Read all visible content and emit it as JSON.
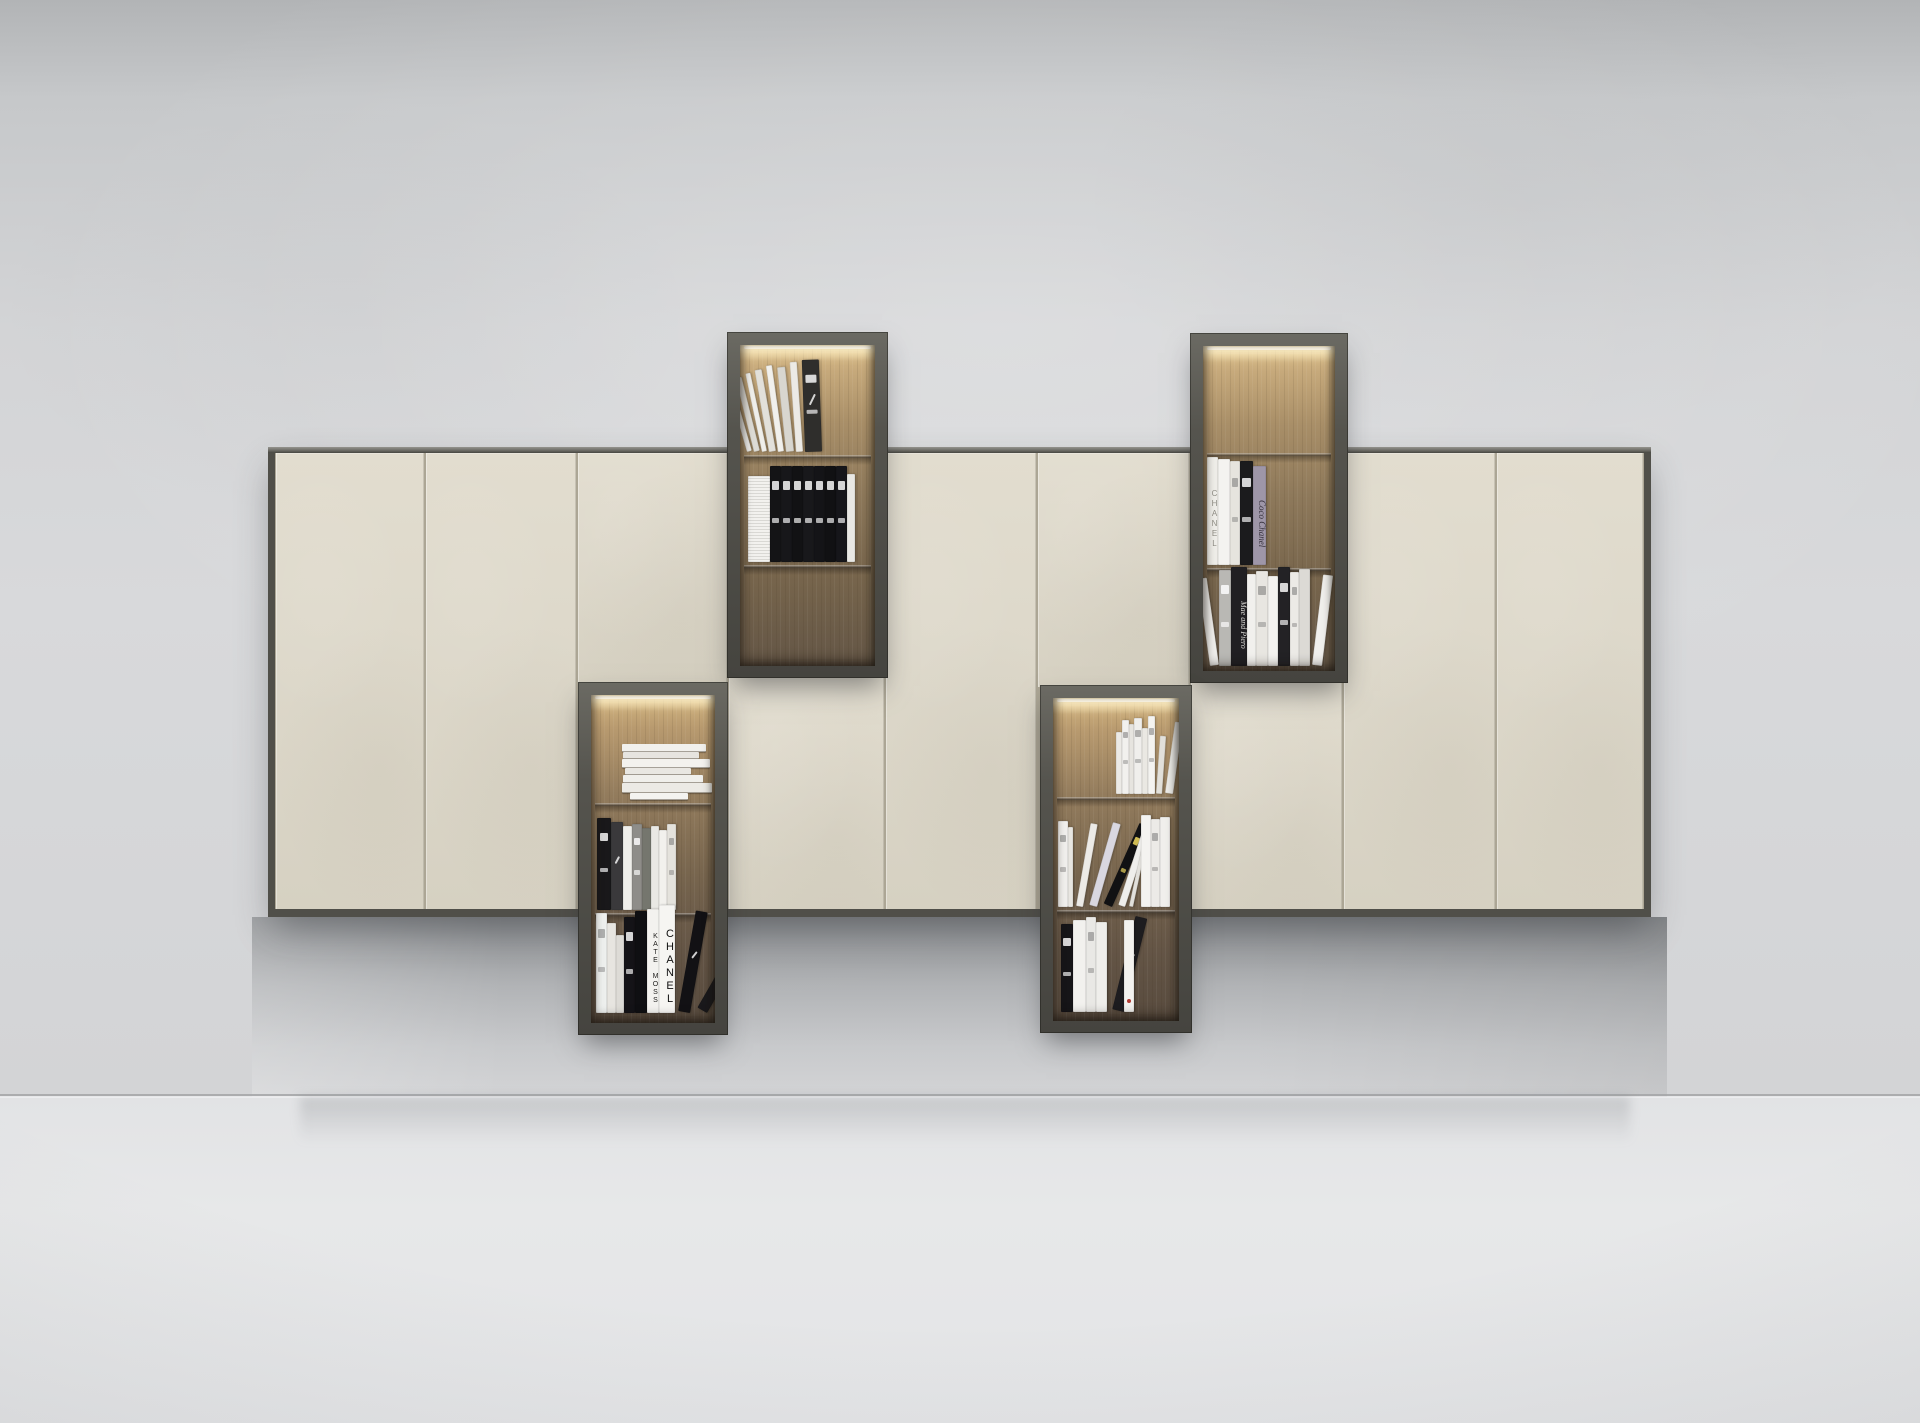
{
  "scene": {
    "width": 1920,
    "height": 1423,
    "label": "Beige wall-mounted cabinet composition with four dark open book niches, LED-lit wood interiors, on plaster wall"
  },
  "palette": {
    "wall_top": "#b2b4b6",
    "wall_mid": "#d8d9db",
    "floor": "#e7e8e9",
    "floor_line": "#a3a5a7",
    "door_cream": "#ddd8ca",
    "door_seam": "#aca695",
    "carcass": "#504f49",
    "niche_frame": "#55544e",
    "wood_lit": "#d7b984",
    "wood_dark": "#5f5244",
    "led_glow": "#fff9e8",
    "book_white": "#f1f0ec",
    "book_black": "#161518"
  },
  "cabinet": {
    "x": 268,
    "y": 447,
    "w": 1383,
    "h": 470,
    "side": 7,
    "door_top": 6,
    "door_bottom": 8,
    "columns": [
      {
        "x": 268,
        "w": 157,
        "type": "full"
      },
      {
        "x": 425,
        "w": 152,
        "type": "full"
      },
      {
        "x": 577,
        "w": 151,
        "type": "upper",
        "until": 684
      },
      {
        "x": 728,
        "w": 157,
        "type": "lower",
        "from": 676
      },
      {
        "x": 885,
        "w": 152,
        "type": "full"
      },
      {
        "x": 1037,
        "w": 153,
        "type": "upper",
        "until": 687
      },
      {
        "x": 1190,
        "w": 153,
        "type": "lower",
        "from": 681
      },
      {
        "x": 1343,
        "w": 153,
        "type": "full"
      },
      {
        "x": 1496,
        "w": 155,
        "type": "full"
      }
    ]
  },
  "niches": [
    {
      "id": "niche-top-left",
      "x": 727,
      "y": 332,
      "w": 161,
      "h": 346,
      "frame": 13,
      "tone": "upper",
      "shelves": [
        110,
        220
      ],
      "sections": [
        {
          "kind": "row",
          "anchor": "left",
          "offset": 5,
          "bottom": 107,
          "books": [
            {
              "w": 5,
              "h": 70,
              "c": "#e8e7e3",
              "lean": -16
            },
            {
              "w": 6,
              "h": 76,
              "c": "#dddbd5",
              "lean": -14
            },
            {
              "w": 5,
              "h": 80,
              "c": "#efeeea",
              "lean": -12
            },
            {
              "w": 7,
              "h": 83,
              "c": "#e2e0da",
              "lean": -10
            },
            {
              "w": 6,
              "h": 87,
              "c": "#f1f0ec",
              "lean": -8
            },
            {
              "w": 8,
              "h": 85,
              "c": "#d8d6cf",
              "lean": -6
            },
            {
              "w": 7,
              "h": 90,
              "c": "#eceae5",
              "lean": -4
            },
            {
              "w": 17,
              "h": 92,
              "c": "#2f2e2c",
              "lean": -2,
              "marks": "w",
              "script": true
            }
          ]
        },
        {
          "kind": "row",
          "anchor": "left",
          "offset": 8,
          "bottom": 217,
          "books": [
            {
              "w": 22,
              "h": 86,
              "c": "#f2f1ee",
              "fore": true
            },
            {
              "w": 11,
              "h": 96,
              "c": "#141416",
              "marks": "w"
            },
            {
              "w": 11,
              "h": 96,
              "c": "#17171a",
              "marks": "w"
            },
            {
              "w": 11,
              "h": 96,
              "c": "#121214",
              "marks": "w"
            },
            {
              "w": 11,
              "h": 96,
              "c": "#18181b",
              "marks": "w"
            },
            {
              "w": 11,
              "h": 96,
              "c": "#141417",
              "marks": "w"
            },
            {
              "w": 11,
              "h": 96,
              "c": "#111113",
              "marks": "w"
            },
            {
              "w": 11,
              "h": 96,
              "c": "#16161a",
              "marks": "w"
            },
            {
              "w": 8,
              "h": 88,
              "c": "#e9e8e4"
            }
          ]
        }
      ]
    },
    {
      "id": "niche-top-right",
      "x": 1190,
      "y": 333,
      "w": 158,
      "h": 350,
      "frame": 13,
      "tone": "upper",
      "shelves": [
        107,
        222
      ],
      "sections": [
        {
          "kind": "row",
          "anchor": "left",
          "offset": 4,
          "bottom": 219,
          "books": [
            {
              "w": 11,
              "h": 108,
              "c": "#efeee9",
              "label": "CHANEL",
              "lc": "#8f8d85",
              "up": true,
              "fs": 8
            },
            {
              "w": 12,
              "h": 106,
              "c": "#f4f3f0"
            },
            {
              "w": 10,
              "h": 104,
              "c": "#e6e4de",
              "marks": "g"
            },
            {
              "w": 13,
              "h": 104,
              "c": "#1b1b1d",
              "marks": "w"
            },
            {
              "w": 13,
              "h": 99,
              "c": "#9e96a8",
              "label": "Coco Chanel",
              "lc": "#322d38",
              "serif": true,
              "fs": 9
            }
          ]
        },
        {
          "kind": "row",
          "anchor": "left",
          "offset": 5,
          "bottom": 320,
          "books": [
            {
              "w": 9,
              "h": 88,
              "c": "#efeeeb",
              "lean": -8
            },
            {
              "w": 12,
              "h": 96,
              "c": "#b9b8b4",
              "marks": "w"
            },
            {
              "w": 16,
              "h": 99,
              "c": "#201f22",
              "label": "Mae and Piero",
              "lc": "#d8d7d3",
              "serif": true,
              "fs": 8
            },
            {
              "w": 9,
              "h": 92,
              "c": "#f1f0ed"
            },
            {
              "w": 12,
              "h": 95,
              "c": "#e8e6e1",
              "marks": "g"
            },
            {
              "w": 10,
              "h": 90,
              "c": "#f3f2ef"
            },
            {
              "w": 12,
              "h": 99,
              "c": "#232225",
              "marks": "w"
            },
            {
              "w": 9,
              "h": 94,
              "c": "#eceae6",
              "marks": "g"
            },
            {
              "w": 11,
              "h": 97,
              "c": "#dcdad5"
            },
            {
              "w": 10,
              "h": 91,
              "c": "#f0efec",
              "lean": 7
            }
          ]
        }
      ]
    },
    {
      "id": "niche-bottom-left",
      "x": 578,
      "y": 682,
      "w": 150,
      "h": 353,
      "frame": 13,
      "tone": "lower",
      "shelves": [
        108,
        218
      ],
      "sections": [
        {
          "kind": "pile",
          "centerOff": 14,
          "bottom": 105,
          "books": [
            {
              "w": 84,
              "h": 7,
              "off": 8,
              "c": "#f1f0ec"
            },
            {
              "w": 76,
              "h": 6,
              "off": 2,
              "c": "#e6e4df"
            },
            {
              "w": 88,
              "h": 8,
              "off": 12,
              "c": "#f3f2ee"
            },
            {
              "w": 66,
              "h": 6,
              "off": -4,
              "c": "#e9e7e2"
            },
            {
              "w": 80,
              "h": 7,
              "off": 6,
              "c": "#f0efeb"
            },
            {
              "w": 90,
              "h": 9,
              "off": 14,
              "c": "#eceae5"
            },
            {
              "w": 58,
              "h": 6,
              "off": -2,
              "c": "#f4f3f0"
            }
          ]
        },
        {
          "kind": "row",
          "anchor": "left",
          "offset": 6,
          "bottom": 215,
          "books": [
            {
              "w": 14,
              "h": 92,
              "c": "#19181a",
              "marks": "w"
            },
            {
              "w": 12,
              "h": 88,
              "c": "#3a393b",
              "script": true
            },
            {
              "w": 9,
              "h": 84,
              "c": "#efeeea"
            },
            {
              "w": 10,
              "h": 86,
              "c": "#8e8d89",
              "marks": "w"
            },
            {
              "w": 9,
              "h": 82,
              "c": "#75766e"
            },
            {
              "w": 8,
              "h": 84,
              "c": "#e9e8e4"
            },
            {
              "w": 8,
              "h": 80,
              "c": "#f2f1ed"
            },
            {
              "w": 9,
              "h": 86,
              "c": "#e4e2dc",
              "marks": "g"
            }
          ]
        },
        {
          "kind": "row",
          "anchor": "left",
          "offset": 5,
          "bottom": 318,
          "books": [
            {
              "w": 11,
              "h": 100,
              "c": "#eef0ee",
              "marks": "g"
            },
            {
              "w": 9,
              "h": 90,
              "c": "#e7e5e0"
            },
            {
              "w": 8,
              "h": 78,
              "c": "#dddbd6"
            },
            {
              "w": 11,
              "h": 96,
              "c": "#141317",
              "marks": "w"
            },
            {
              "w": 12,
              "h": 102,
              "c": "#0f0f12"
            },
            {
              "w": 12,
              "h": 104,
              "c": "#f3f2ef",
              "label": "KATE MOSS",
              "lc": "#1d1c1a",
              "up": true,
              "fs": 7
            },
            {
              "w": 16,
              "h": 108,
              "c": "#f6f5f2",
              "label": "CHANEL",
              "lc": "#101010",
              "up": true,
              "fs": 11
            },
            {
              "w": 12,
              "h": 102,
              "c": "#121114",
              "script": true,
              "lean": 10
            },
            {
              "w": 11,
              "h": 96,
              "c": "#1a191c",
              "lean": 30
            }
          ]
        }
      ]
    },
    {
      "id": "niche-bottom-right",
      "x": 1040,
      "y": 685,
      "w": 152,
      "h": 348,
      "frame": 13,
      "tone": "lower",
      "shelves": [
        99,
        212
      ],
      "sections": [
        {
          "kind": "row",
          "anchor": "right",
          "offset": 6,
          "bottom": 96,
          "books": [
            {
              "w": 6,
              "h": 62,
              "c": "#eceae6"
            },
            {
              "w": 7,
              "h": 74,
              "c": "#f2f1ee",
              "marks": "g"
            },
            {
              "w": 5,
              "h": 70,
              "c": "#e6e4df"
            },
            {
              "w": 8,
              "h": 76,
              "c": "#f0efec",
              "marks": "g"
            },
            {
              "w": 6,
              "h": 66,
              "c": "#eae8e3"
            },
            {
              "w": 7,
              "h": 78,
              "c": "#f4f3f0",
              "marks": "g"
            },
            {
              "w": 6,
              "h": 58,
              "c": "#e2e0da",
              "lean": 4
            },
            {
              "w": 8,
              "h": 72,
              "c": "#edece8",
              "lean": 8
            }
          ]
        },
        {
          "kind": "row",
          "anchor": "left",
          "offset": 5,
          "bottom": 209,
          "books": [
            {
              "w": 10,
              "h": 86,
              "c": "#f1f0ed",
              "marks": "g"
            },
            {
              "w": 5,
              "h": 80,
              "c": "#e8e6e1"
            },
            {
              "w": 7,
              "h": 84,
              "c": "#eceae6",
              "lean": 10
            },
            {
              "w": 8,
              "h": 86,
              "c": "#d9d7e0",
              "lean": 16
            },
            {
              "w": 9,
              "h": 88,
              "c": "#111113",
              "lean": 24,
              "marks": "y"
            },
            {
              "w": 7,
              "h": 82,
              "c": "#efeeeb",
              "lean": 18
            },
            {
              "w": 4,
              "h": 78,
              "c": "#e2e0db",
              "lean": 12
            },
            {
              "w": 10,
              "h": 92,
              "c": "#f4f3f0",
              "g": 8
            },
            {
              "w": 9,
              "h": 88,
              "c": "#eceae7",
              "marks": "g"
            },
            {
              "w": 10,
              "h": 90,
              "c": "#f0efec"
            }
          ]
        },
        {
          "kind": "row",
          "anchor": "left",
          "offset": 8,
          "bottom": 314,
          "books": [
            {
              "w": 12,
              "h": 88,
              "c": "#161518",
              "marks": "w"
            },
            {
              "w": 13,
              "h": 92,
              "c": "#f2f1ee"
            },
            {
              "w": 10,
              "h": 95,
              "c": "#e9e8e5",
              "marks": "g"
            },
            {
              "w": 11,
              "h": 90,
              "c": "#efeeeb"
            },
            {
              "w": 12,
              "h": 96,
              "c": "#1d1c1f",
              "lean": 14,
              "script": true
            },
            {
              "w": 10,
              "h": 92,
              "c": "#f3f2ef",
              "dot": true
            }
          ]
        }
      ]
    }
  ]
}
